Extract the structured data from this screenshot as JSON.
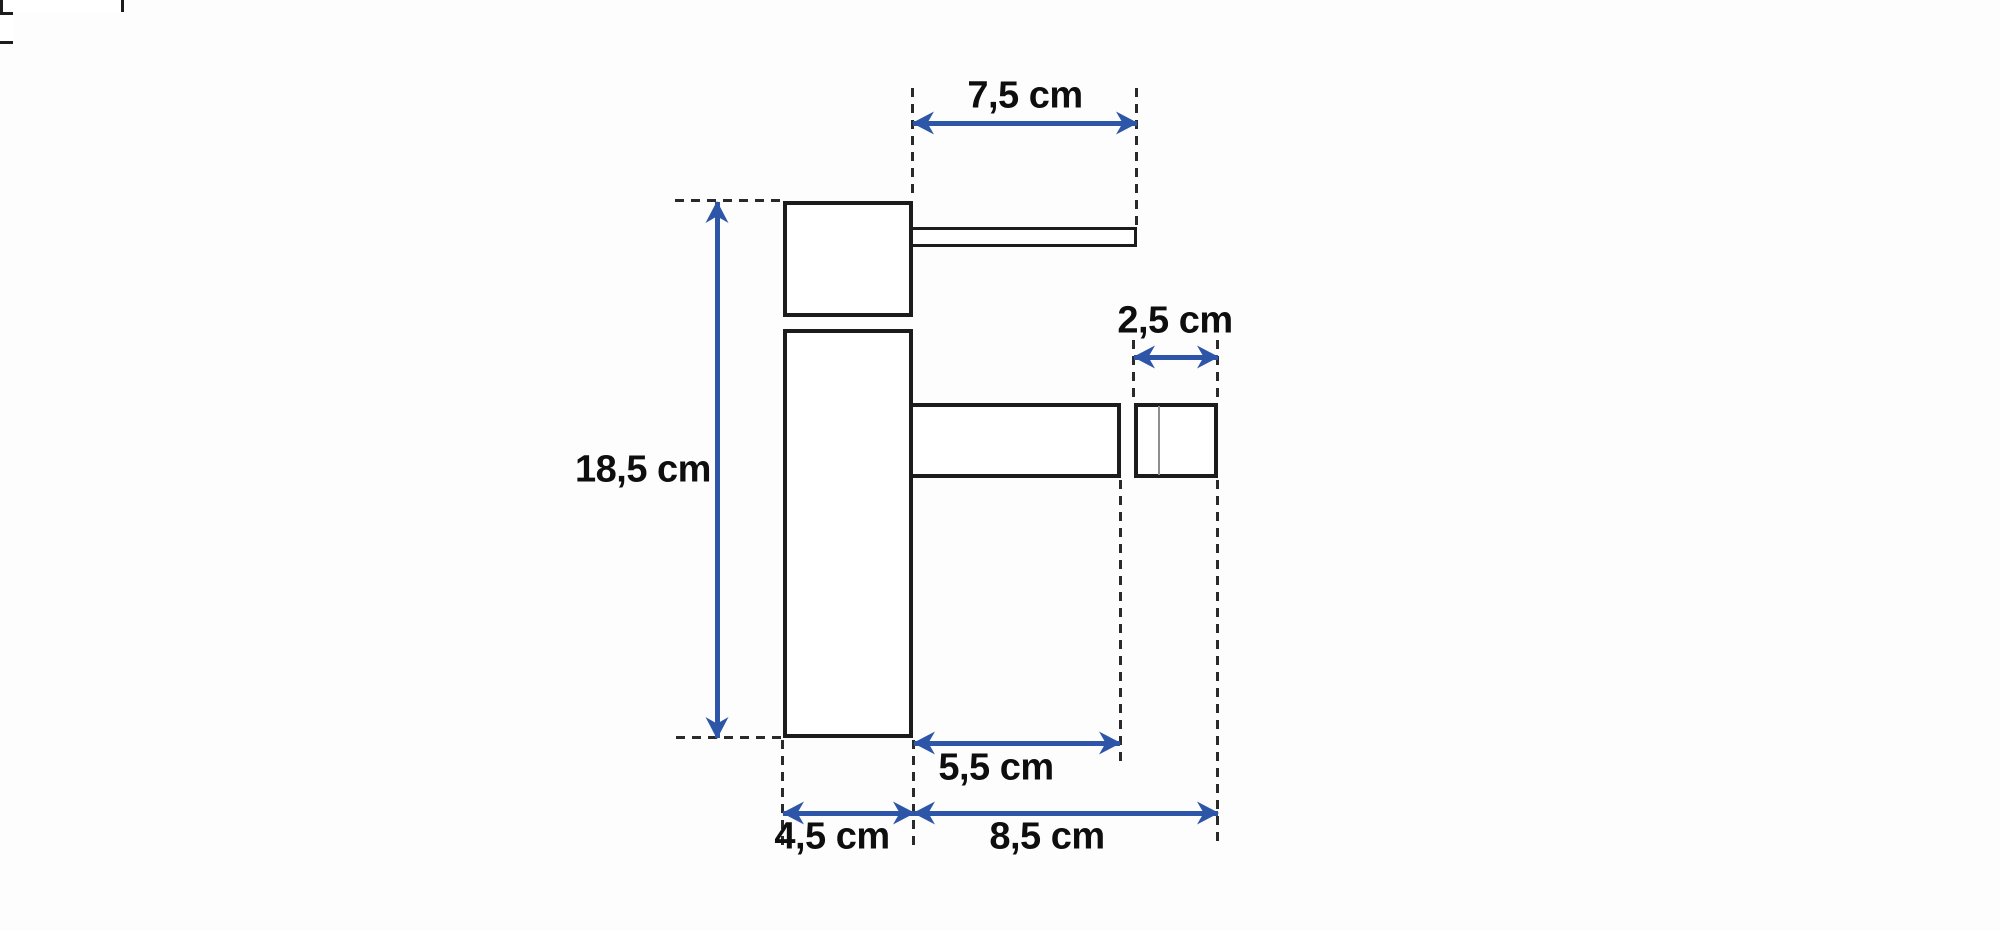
{
  "page": {
    "background": "#fdfdfd"
  },
  "diagram": {
    "title": "Faucet dimension drawing (side view)",
    "unit": "cm",
    "colors": {
      "outline": "#1c1c1c",
      "dimension_arrow": "#2d56a8",
      "label_text": "#0e0e0e"
    },
    "parts": [
      "handle-block",
      "collar-ring",
      "body-column",
      "lever-handle",
      "spout",
      "spout-neck",
      "aerator"
    ],
    "dimensions": {
      "handle_length": {
        "label": "7,5 cm",
        "value": 7.5,
        "orientation": "horizontal",
        "measures": "lever handle length"
      },
      "aerator_width": {
        "label": "2,5 cm",
        "value": 2.5,
        "orientation": "horizontal",
        "measures": "aerator length"
      },
      "total_height": {
        "label": "18,5 cm",
        "value": 18.5,
        "orientation": "vertical",
        "measures": "total body height"
      },
      "spout_length": {
        "label": "5,5 cm",
        "value": 5.5,
        "orientation": "horizontal",
        "measures": "spout length"
      },
      "base_width": {
        "label": "4,5 cm",
        "value": 4.5,
        "orientation": "horizontal",
        "measures": "body width"
      },
      "spout_reach": {
        "label": "8,5 cm",
        "value": 8.5,
        "orientation": "horizontal",
        "measures": "total spout reach"
      }
    }
  }
}
